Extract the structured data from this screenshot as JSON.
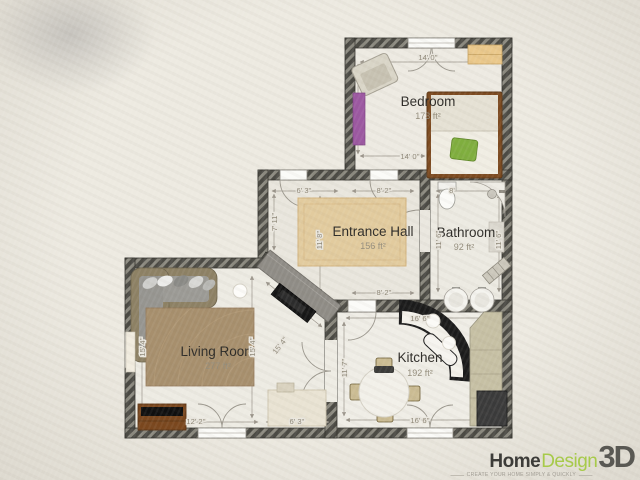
{
  "logo": {
    "home": "Home",
    "design": "Design",
    "threed": "3D",
    "tagline": "CREATE YOUR HOME SIMPLY & QUICKLY"
  },
  "colors": {
    "background": "#e9e5dc",
    "wall_dark": "#4b4a44",
    "wall_stripe": "#8b897f",
    "floor": "#edeae2",
    "logo_green": "#a7ca4a",
    "hall_rug": "#e2cb9e",
    "living_rug": "#a78f6d",
    "accent_purple": "#9c58a1",
    "accent_green_pillow": "#7fae3e"
  },
  "rooms": {
    "bedroom": {
      "name": "Bedroom",
      "area": "173 ft²"
    },
    "hall": {
      "name": "Entrance Hall",
      "area": "156 ft²"
    },
    "bathroom": {
      "name": "Bathroom",
      "area": "92 ft²"
    },
    "living": {
      "name": "Living Room",
      "area": "277 ft²"
    },
    "kitchen": {
      "name": "Kitchen",
      "area": "192 ft²"
    }
  },
  "dims": {
    "bedroom_top": "14' 0''",
    "bedroom_bottom": "14' 0''",
    "hall_top_left": "6' 3''",
    "hall_top_right": "8' 2''",
    "hall_left": "7' 11''",
    "hall_inner": "11' 8''",
    "hall_bottom": "8' 2''",
    "bath_top": "8'",
    "bath_left": "11' 6''",
    "bath_right": "11' 6''",
    "living_left": "15' 4''",
    "living_inner": "15' 4''",
    "living_diag": "15' 4''",
    "living_bottom_left": "12' 2''",
    "living_bottom_right": "6' 3''",
    "kitchen_top": "16' 6''",
    "kitchen_left": "11' 7''",
    "kitchen_bottom": "16' 6''"
  }
}
